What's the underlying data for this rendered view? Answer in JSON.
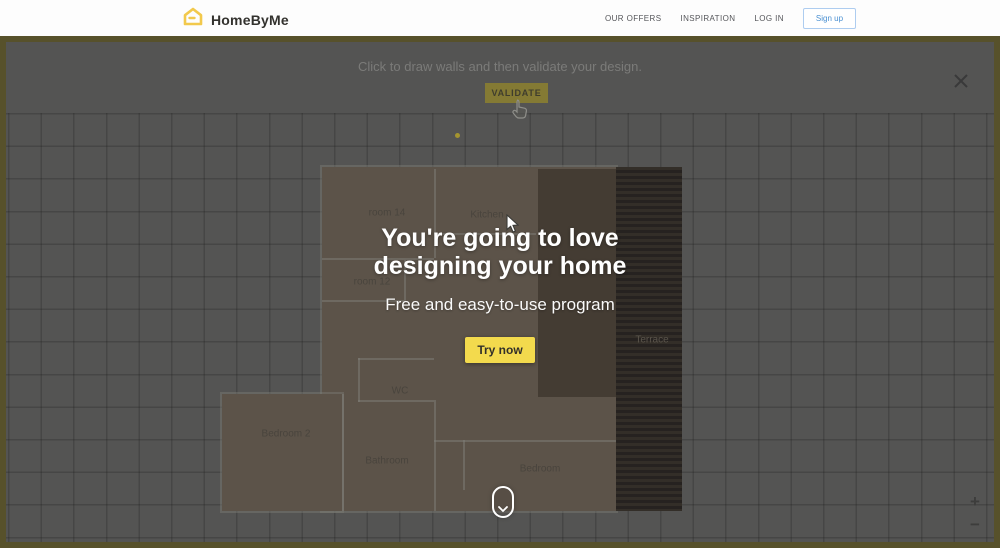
{
  "header": {
    "brand": "HomeByMe",
    "nav": [
      {
        "label": "OUR OFFERS"
      },
      {
        "label": "INSPIRATION"
      },
      {
        "label": "LOG IN"
      }
    ],
    "signup_label": "Sign up"
  },
  "banner": {
    "instruction": "Click to draw walls and then validate your design.",
    "validate_label": "VALIDATE"
  },
  "promo": {
    "title_line1": "You're going to love",
    "title_line2": "designing your home",
    "subtitle": "Free and easy-to-use program",
    "cta_label": "Try now"
  },
  "floorplan": {
    "rooms": [
      {
        "label": "room 14"
      },
      {
        "label": "Kitchen"
      },
      {
        "label": "room 12"
      },
      {
        "label": "WC"
      },
      {
        "label": "Bedroom 2"
      },
      {
        "label": "Bathroom"
      },
      {
        "label": "Bedroom"
      },
      {
        "label": "Terrace"
      }
    ]
  },
  "controls": {
    "close_glyph": "✕",
    "zoom_in_glyph": "+",
    "zoom_out_glyph": "−"
  },
  "colors": {
    "brand_yellow": "#f2c94c",
    "cta_yellow": "#f3da4d",
    "signup_blue": "#4a90d2",
    "canvas_overlay": "#545453",
    "plan_floor": "#5c5349"
  }
}
